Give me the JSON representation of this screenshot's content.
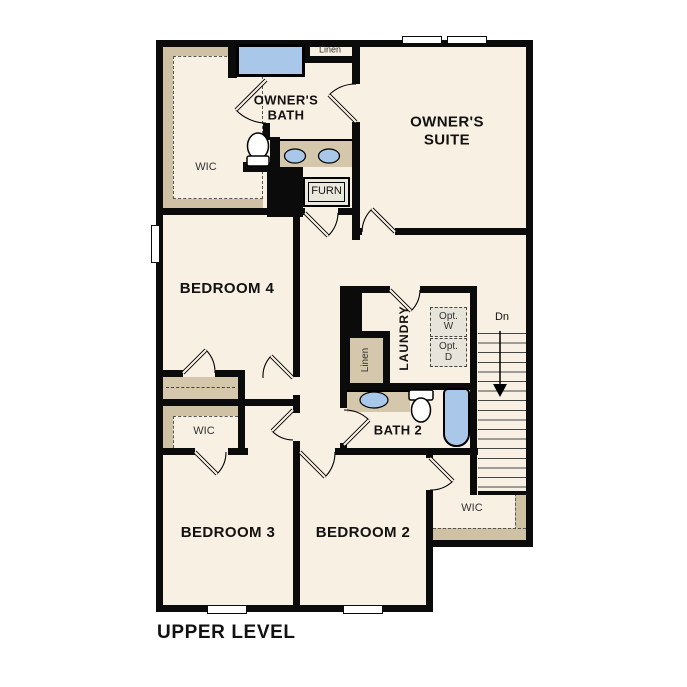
{
  "title": "UPPER LEVEL",
  "colors": {
    "floor": "#f8f0e3",
    "tan": "#d4c7ab",
    "tan2": "#cfc1a4",
    "blue": "#a9c8e9",
    "wall": "#0b0b0b",
    "optbox": "#e7e4da"
  },
  "rooms": {
    "owners_suite": "OWNER'S\nSUITE",
    "owners_bath": "OWNER'S\nBATH",
    "owners_wic": "WIC",
    "linen_bath": "Linen",
    "furnace": "FURN",
    "bedroom4": "BEDROOM 4",
    "laundry": "LAUNDRY",
    "linen_hall": "Linen",
    "opt_washer": "Opt.\nW",
    "opt_dryer": "Opt.\nD",
    "bath2": "BATH 2",
    "bedroom3": "BEDROOM 3",
    "bedroom3_wic": "WIC",
    "bedroom2": "BEDROOM 2",
    "bedroom2_wic": "WIC"
  },
  "stairs": {
    "label": "Dn",
    "direction": "down"
  }
}
